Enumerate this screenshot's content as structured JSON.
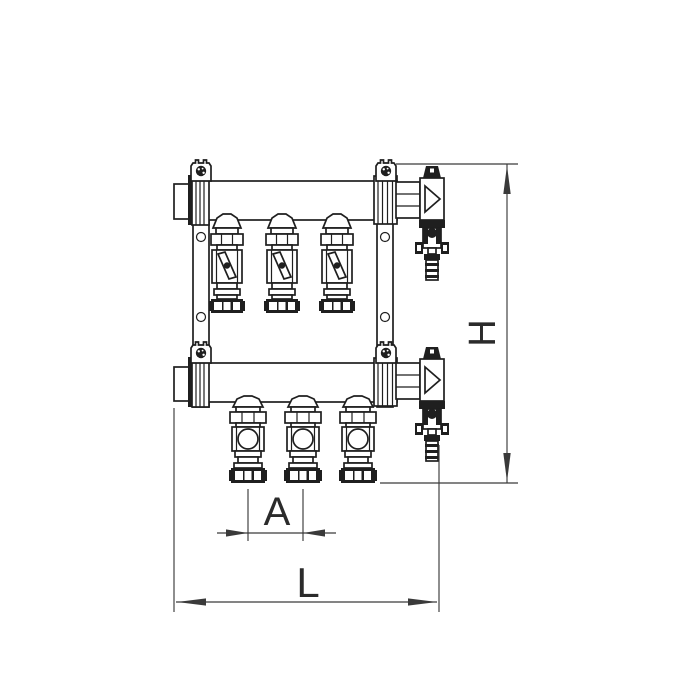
{
  "page": {
    "background": "#ffffff"
  },
  "drawing": {
    "type": "technical-line-drawing",
    "subject": "3-loop heating manifold pair with valves, front view",
    "ink_color": "#1f1f1f",
    "dimension_line_color": "#3a3a3a",
    "loop_count_top": 3,
    "loop_count_bottom": 3
  },
  "dimensions": {
    "h_label": "H",
    "a_label": "A",
    "l_label": "L"
  }
}
